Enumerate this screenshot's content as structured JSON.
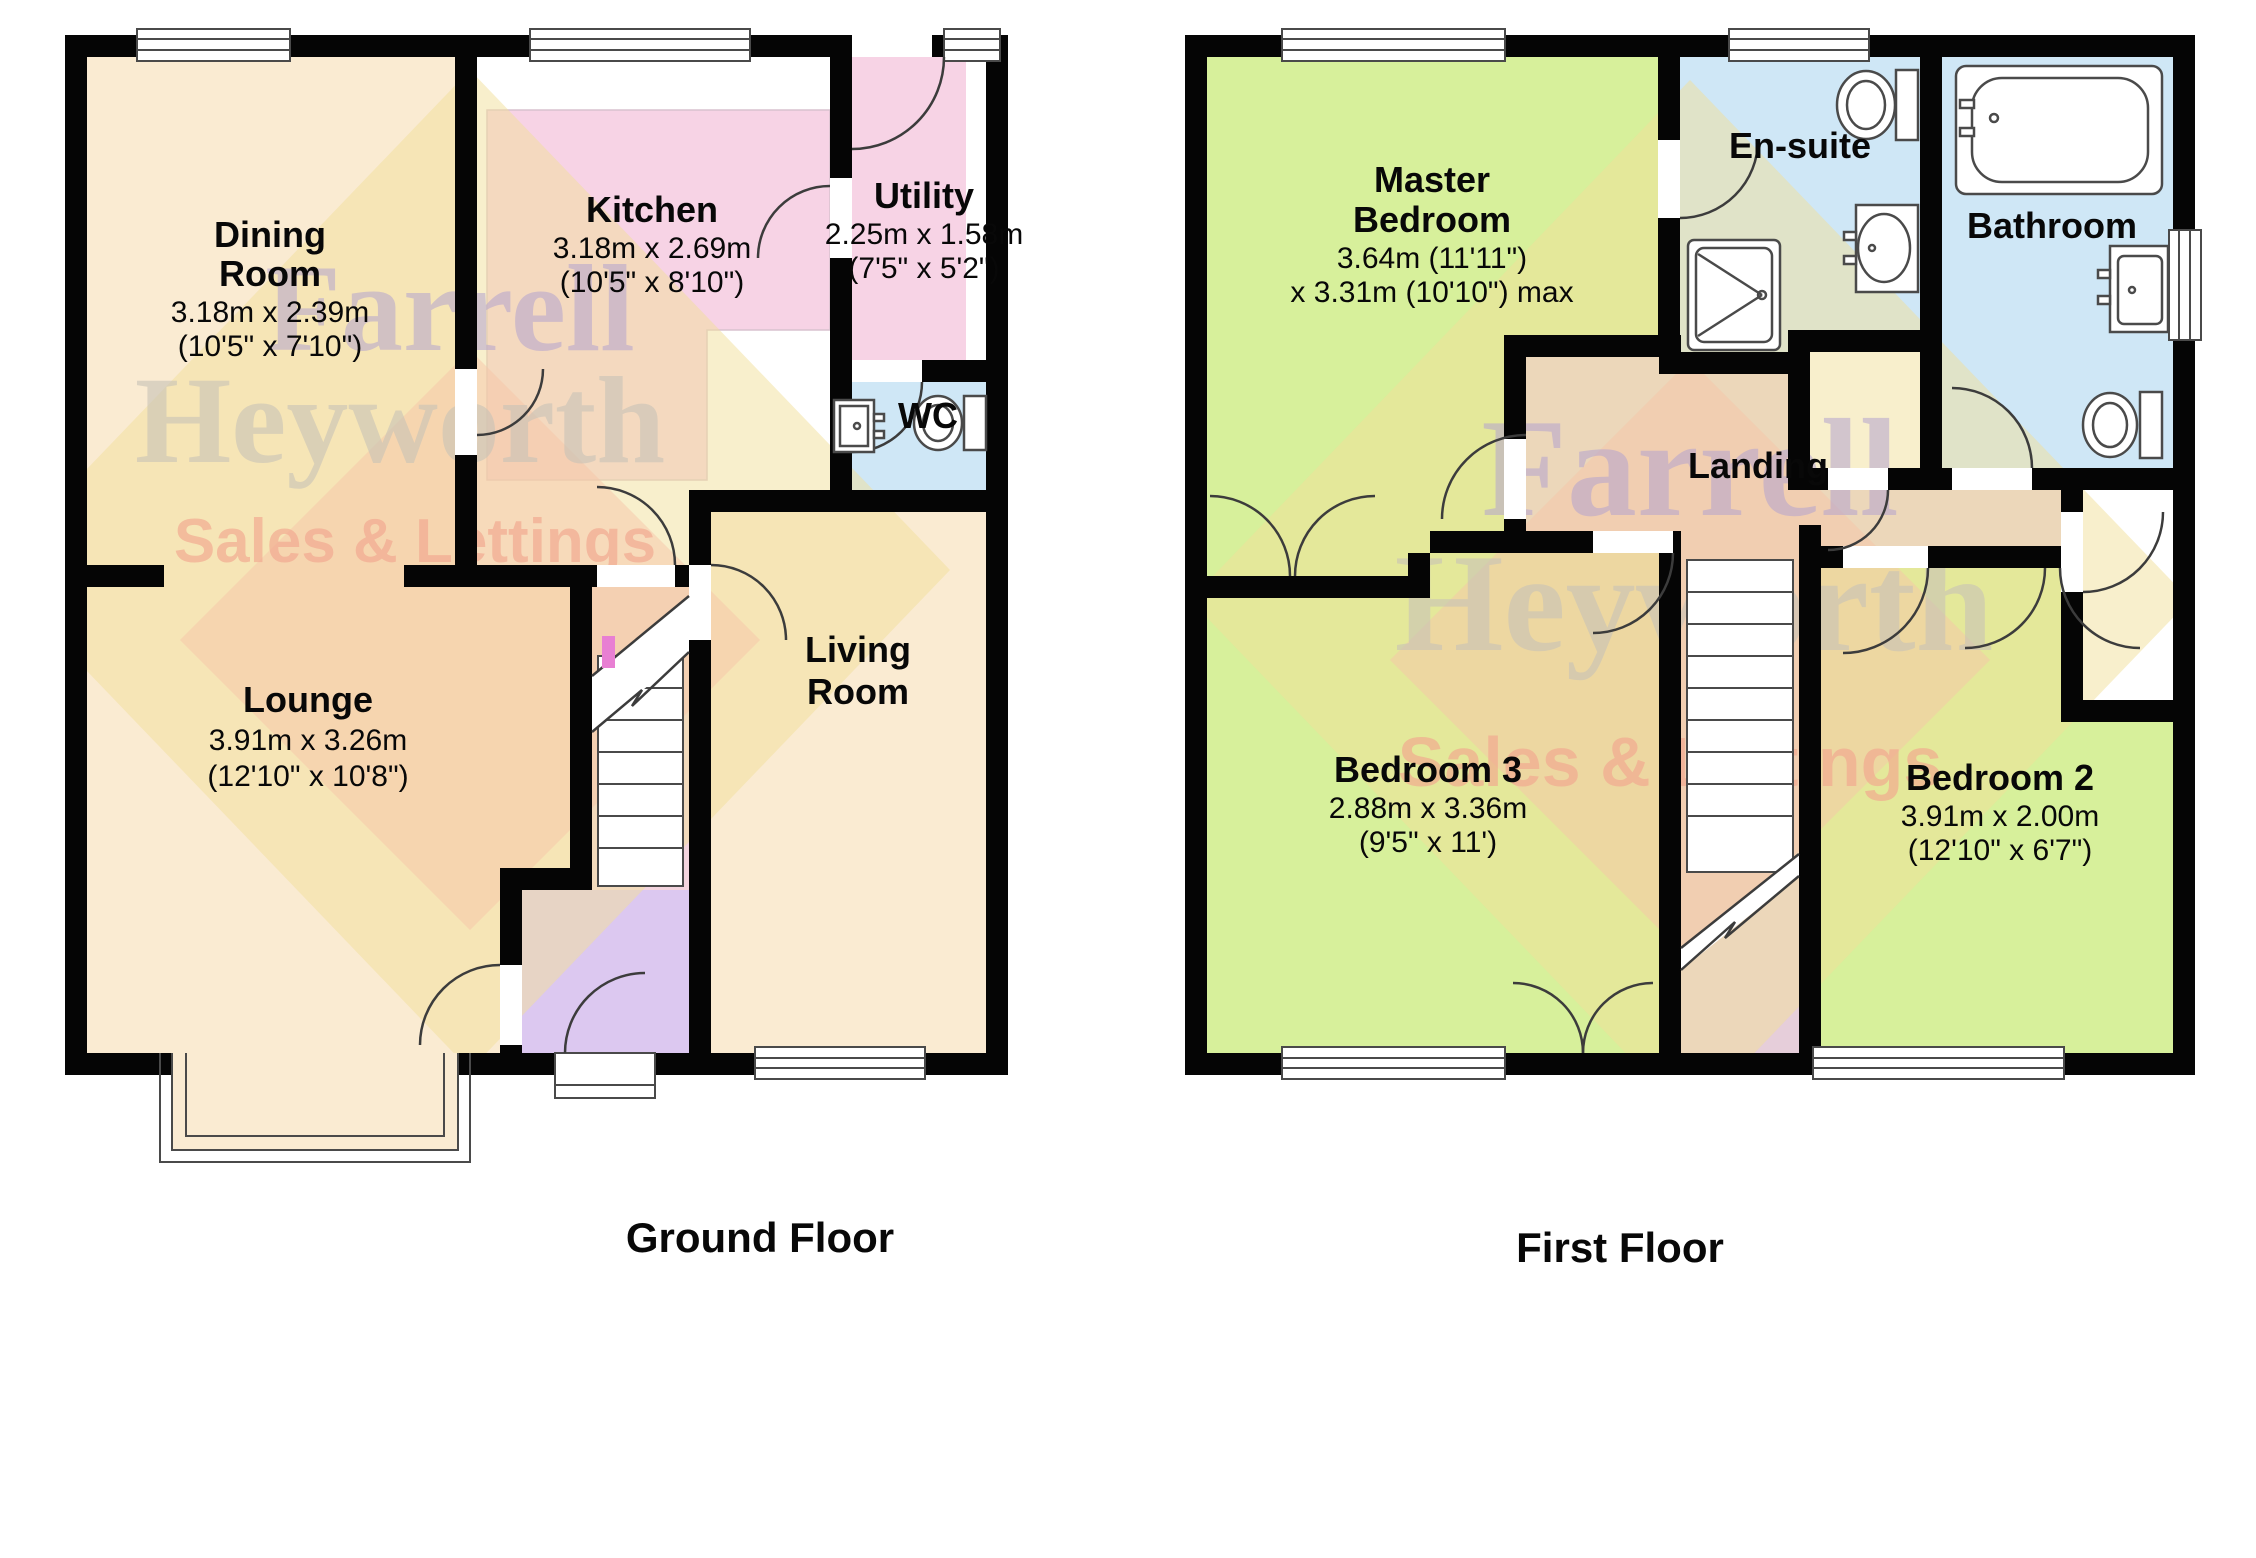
{
  "document": {
    "type": "estate-agent-floorplan",
    "ground_floor_label": "Ground Floor",
    "first_floor_label": "First Floor"
  },
  "watermark": {
    "line1": "Farrell",
    "line2": "Heyworth",
    "line3": "Sales & Lettings"
  },
  "palette": {
    "room_cream": "#FAEBD2",
    "room_green": "#D7F09B",
    "room_pink": "#F7D3E5",
    "room_blue": "#CFE7F6",
    "hall_purple": "#DCC8F0",
    "landing_mauve": "#E6CEDA",
    "stair_pink": "#F3D4DE",
    "wall_black": "#050505",
    "watermark_gold": "#F2E09A",
    "watermark_salmon": "#F6C6A8",
    "watermark_purple": "#B4A4CF",
    "watermark_gray": "#C8C3B7"
  },
  "ground_floor": {
    "label": "Ground Floor",
    "rooms": {
      "dining": {
        "label_lines": [
          "Dining",
          "Room"
        ],
        "dims_lines": [
          "3.18m x 2.39m",
          "(10'5\" x 7'10\")"
        ]
      },
      "kitchen": {
        "label_lines": [
          "Kitchen"
        ],
        "dims_lines": [
          "3.18m x 2.69m",
          "(10'5\" x 8'10\")"
        ]
      },
      "utility": {
        "label_lines": [
          "Utility"
        ],
        "dims_lines": [
          "2.25m x 1.58m",
          "(7'5\" x 5'2\")"
        ]
      },
      "wc": {
        "label_lines": [
          "WC"
        ],
        "dims_lines": []
      },
      "lounge": {
        "label_lines": [
          "Lounge"
        ],
        "dims_lines": [
          "3.91m x 3.26m",
          "(12'10\" x 10'8\")"
        ]
      },
      "living": {
        "label_lines": [
          "Living",
          "Room"
        ],
        "dims_lines": []
      }
    }
  },
  "first_floor": {
    "label": "First Floor",
    "rooms": {
      "master": {
        "label_lines": [
          "Master",
          "Bedroom"
        ],
        "dims_lines": [
          "3.64m (11'11\")",
          "x 3.31m (10'10\") max"
        ]
      },
      "ensuite": {
        "label_lines": [
          "En-suite"
        ],
        "dims_lines": []
      },
      "bathroom": {
        "label_lines": [
          "Bathroom"
        ],
        "dims_lines": []
      },
      "landing": {
        "label_lines": [
          "Landing"
        ],
        "dims_lines": []
      },
      "bedroom3": {
        "label_lines": [
          "Bedroom 3"
        ],
        "dims_lines": [
          "2.88m x 3.36m",
          "(9'5\" x 11')"
        ]
      },
      "bedroom2": {
        "label_lines": [
          "Bedroom 2"
        ],
        "dims_lines": [
          "3.91m x 2.00m",
          "(12'10\" x 6'7\")"
        ]
      }
    }
  }
}
